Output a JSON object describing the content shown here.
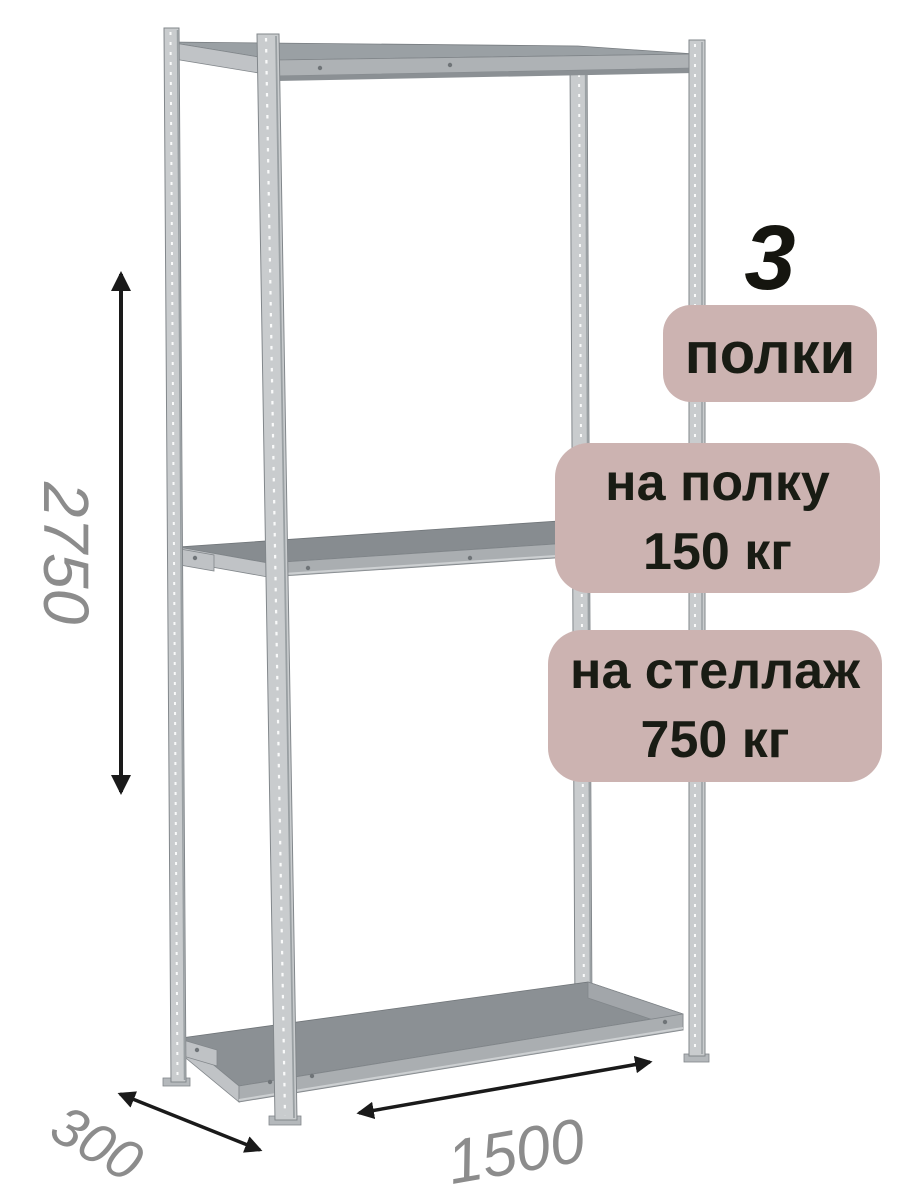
{
  "illustration": {
    "name": "metal-shelving-rack",
    "shelf_count": "3",
    "post_color": "#c9ccce",
    "shelf_surface_color": "#878c90",
    "shelf_edge_color": "#aaaeb1"
  },
  "badges": {
    "background": "#ccb3b1",
    "text_color": "#191c14",
    "count_number": "3",
    "count_label": "полки",
    "shelf_load_line1": "на полку",
    "shelf_load_line2": "150 кг",
    "rack_load_line1": "на стеллаж",
    "rack_load_line2": "750 кг"
  },
  "dimensions": {
    "height": "2750",
    "depth": "300",
    "width": "1500",
    "label_color": "#8c8c8c",
    "arrow_color": "#1a1a1a"
  }
}
